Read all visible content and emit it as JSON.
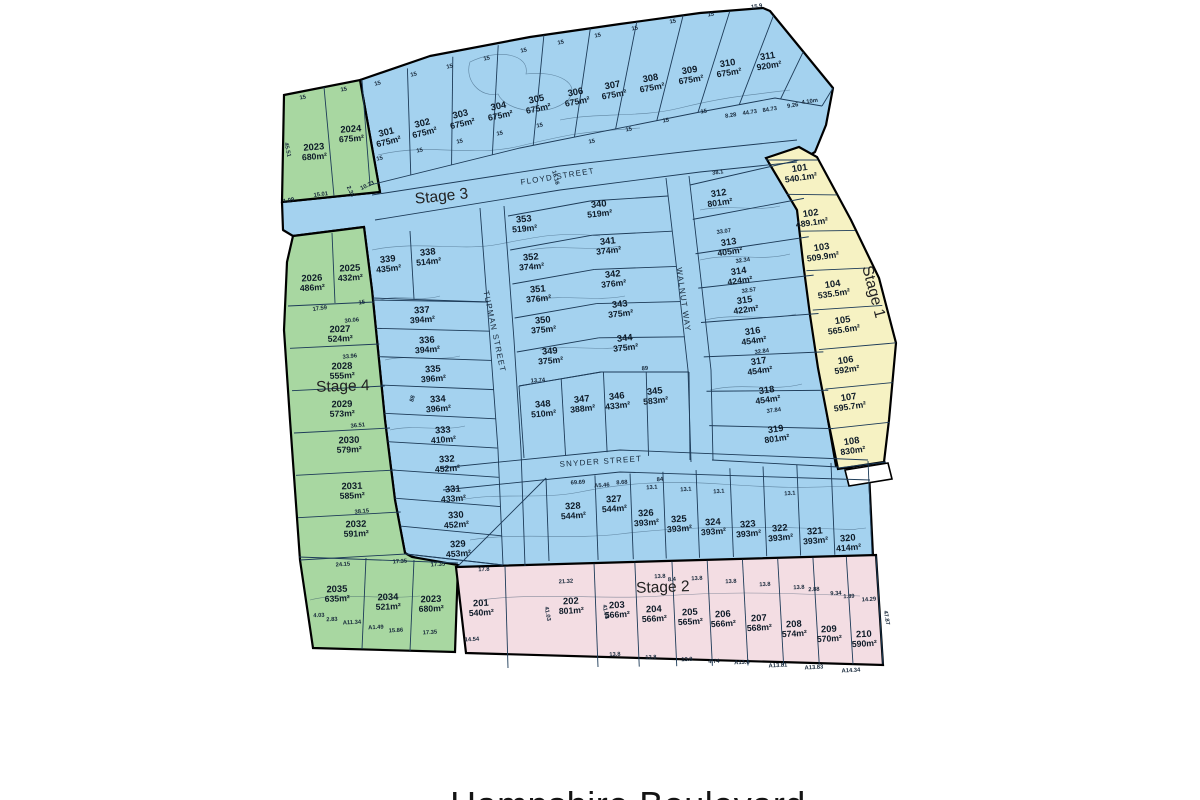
{
  "title": "Hampshire Boulevard",
  "colors": {
    "stage1_fill": "#f6f2c3",
    "stage2_fill": "#f3dde3",
    "stage3_fill": "#a4d2ef",
    "stage4_fill": "#a8d7a1",
    "parcel_line": "#1d3b58",
    "outline": "#000000",
    "background": "#ffffff",
    "label_text": "#0e1b28"
  },
  "streets": [
    {
      "name": "FLOYD STREET",
      "x": 558,
      "y": 179,
      "r": -9
    },
    {
      "name": "TUPMAN STREET",
      "x": 492,
      "y": 332,
      "r": 78
    },
    {
      "name": "WALNUT WAY",
      "x": 681,
      "y": 300,
      "r": 82
    },
    {
      "name": "SNYDER STREET",
      "x": 601,
      "y": 464,
      "r": -4
    }
  ],
  "stages": [
    {
      "label": "Stage 1",
      "x": 869,
      "y": 293,
      "r": 75,
      "lots": [
        {
          "id": "101",
          "area": "540.1m²",
          "x": 800,
          "y": 171,
          "r": -8
        },
        {
          "id": "102",
          "area": "489.1m²",
          "x": 811,
          "y": 216,
          "r": -8
        },
        {
          "id": "103",
          "area": "509.9m²",
          "x": 822,
          "y": 250,
          "r": -8
        },
        {
          "id": "104",
          "area": "535.5m²",
          "x": 833,
          "y": 287,
          "r": -8
        },
        {
          "id": "105",
          "area": "565.6m²",
          "x": 843,
          "y": 323,
          "r": -8
        },
        {
          "id": "106",
          "area": "592m²",
          "x": 846,
          "y": 363,
          "r": -8
        },
        {
          "id": "107",
          "area": "595.7m²",
          "x": 849,
          "y": 400,
          "r": -8
        },
        {
          "id": "108",
          "area": "830m²",
          "x": 852,
          "y": 444,
          "r": -8
        }
      ]
    },
    {
      "label": "Stage 2",
      "x": 663,
      "y": 592,
      "r": -2,
      "lots": [
        {
          "id": "201",
          "area": "540m²",
          "x": 481,
          "y": 606,
          "r": -3
        },
        {
          "id": "202",
          "area": "801m²",
          "x": 571,
          "y": 604,
          "r": -3
        },
        {
          "id": "203",
          "area": "566m²",
          "x": 617,
          "y": 608,
          "r": -3
        },
        {
          "id": "204",
          "area": "566m²",
          "x": 654,
          "y": 612,
          "r": -3
        },
        {
          "id": "205",
          "area": "565m²",
          "x": 690,
          "y": 615,
          "r": -3
        },
        {
          "id": "206",
          "area": "566m²",
          "x": 723,
          "y": 617,
          "r": -3
        },
        {
          "id": "207",
          "area": "568m²",
          "x": 759,
          "y": 621,
          "r": -3
        },
        {
          "id": "208",
          "area": "574m²",
          "x": 794,
          "y": 627,
          "r": -3
        },
        {
          "id": "209",
          "area": "570m²",
          "x": 829,
          "y": 632,
          "r": -3
        },
        {
          "id": "210",
          "area": "590m²",
          "x": 864,
          "y": 637,
          "r": -3
        }
      ]
    },
    {
      "label": "Stage 3",
      "x": 442,
      "y": 201,
      "r": -6,
      "lots": [
        {
          "id": "301",
          "area": "675m²",
          "x": 387,
          "y": 135,
          "r": -14
        },
        {
          "id": "302",
          "area": "675m²",
          "x": 423,
          "y": 126,
          "r": -14
        },
        {
          "id": "303",
          "area": "675m²",
          "x": 461,
          "y": 117,
          "r": -13
        },
        {
          "id": "304",
          "area": "675m²",
          "x": 499,
          "y": 109,
          "r": -12
        },
        {
          "id": "305",
          "area": "675m²",
          "x": 537,
          "y": 102,
          "r": -12
        },
        {
          "id": "306",
          "area": "675m²",
          "x": 576,
          "y": 95,
          "r": -11
        },
        {
          "id": "307",
          "area": "675m²",
          "x": 613,
          "y": 88,
          "r": -10
        },
        {
          "id": "308",
          "area": "675m²",
          "x": 651,
          "y": 81,
          "r": -10
        },
        {
          "id": "309",
          "area": "675m²",
          "x": 690,
          "y": 73,
          "r": -9
        },
        {
          "id": "310",
          "area": "675m²",
          "x": 728,
          "y": 66,
          "r": -9
        },
        {
          "id": "311",
          "area": "920m²",
          "x": 768,
          "y": 59,
          "r": -9
        },
        {
          "id": "312",
          "area": "801m²",
          "x": 719,
          "y": 196,
          "r": -8
        },
        {
          "id": "313",
          "area": "405m²",
          "x": 729,
          "y": 245,
          "r": -8
        },
        {
          "id": "314",
          "area": "424m²",
          "x": 739,
          "y": 274,
          "r": -8
        },
        {
          "id": "315",
          "area": "422m²",
          "x": 745,
          "y": 303,
          "r": -8
        },
        {
          "id": "316",
          "area": "454m²",
          "x": 753,
          "y": 334,
          "r": -8
        },
        {
          "id": "317",
          "area": "454m²",
          "x": 759,
          "y": 364,
          "r": -8
        },
        {
          "id": "318",
          "area": "454m²",
          "x": 767,
          "y": 393,
          "r": -8
        },
        {
          "id": "319",
          "area": "801m²",
          "x": 776,
          "y": 432,
          "r": -8
        },
        {
          "id": "320",
          "area": "414m²",
          "x": 848,
          "y": 541,
          "r": -5
        },
        {
          "id": "321",
          "area": "393m²",
          "x": 815,
          "y": 534,
          "r": -5
        },
        {
          "id": "322",
          "area": "393m²",
          "x": 780,
          "y": 531,
          "r": -5
        },
        {
          "id": "323",
          "area": "393m²",
          "x": 748,
          "y": 527,
          "r": -5
        },
        {
          "id": "324",
          "area": "393m²",
          "x": 713,
          "y": 525,
          "r": -4
        },
        {
          "id": "325",
          "area": "393m²",
          "x": 679,
          "y": 522,
          "r": -4
        },
        {
          "id": "326",
          "area": "393m²",
          "x": 646,
          "y": 516,
          "r": -4
        },
        {
          "id": "327",
          "area": "544m²",
          "x": 614,
          "y": 502,
          "r": -4
        },
        {
          "id": "328",
          "area": "544m²",
          "x": 573,
          "y": 509,
          "r": -4
        },
        {
          "id": "329",
          "area": "453m²",
          "x": 458,
          "y": 547,
          "r": -4
        },
        {
          "id": "330",
          "area": "452m²",
          "x": 456,
          "y": 518,
          "r": -4
        },
        {
          "id": "331",
          "area": "433m²",
          "x": 453,
          "y": 492,
          "r": -4
        },
        {
          "id": "332",
          "area": "452m²",
          "x": 447,
          "y": 462,
          "r": -4
        },
        {
          "id": "333",
          "area": "410m²",
          "x": 443,
          "y": 433,
          "r": -4
        },
        {
          "id": "334",
          "area": "396m²",
          "x": 438,
          "y": 402,
          "r": -4
        },
        {
          "id": "335",
          "area": "396m²",
          "x": 433,
          "y": 372,
          "r": -4
        },
        {
          "id": "336",
          "area": "394m²",
          "x": 427,
          "y": 343,
          "r": -4
        },
        {
          "id": "337",
          "area": "394m²",
          "x": 422,
          "y": 313,
          "r": -4
        },
        {
          "id": "338",
          "area": "514m²",
          "x": 428,
          "y": 255,
          "r": -6
        },
        {
          "id": "339",
          "area": "435m²",
          "x": 388,
          "y": 262,
          "r": -6
        },
        {
          "id": "340",
          "area": "519m²",
          "x": 599,
          "y": 207,
          "r": -6
        },
        {
          "id": "341",
          "area": "374m²",
          "x": 608,
          "y": 244,
          "r": -6
        },
        {
          "id": "342",
          "area": "376m²",
          "x": 613,
          "y": 277,
          "r": -6
        },
        {
          "id": "343",
          "area": "375m²",
          "x": 620,
          "y": 307,
          "r": -6
        },
        {
          "id": "344",
          "area": "375m²",
          "x": 625,
          "y": 341,
          "r": -6
        },
        {
          "id": "345",
          "area": "583m²",
          "x": 655,
          "y": 394,
          "r": -6
        },
        {
          "id": "346",
          "area": "433m²",
          "x": 617,
          "y": 399,
          "r": -6
        },
        {
          "id": "347",
          "area": "388m²",
          "x": 582,
          "y": 402,
          "r": -6
        },
        {
          "id": "348",
          "area": "510m²",
          "x": 543,
          "y": 407,
          "r": -5
        },
        {
          "id": "349",
          "area": "375m²",
          "x": 550,
          "y": 354,
          "r": -5
        },
        {
          "id": "350",
          "area": "375m²",
          "x": 543,
          "y": 323,
          "r": -5
        },
        {
          "id": "351",
          "area": "376m²",
          "x": 538,
          "y": 292,
          "r": -5
        },
        {
          "id": "352",
          "area": "374m²",
          "x": 531,
          "y": 260,
          "r": -5
        },
        {
          "id": "353",
          "area": "519m²",
          "x": 524,
          "y": 222,
          "r": -5
        }
      ]
    },
    {
      "label": "Stage 4",
      "x": 343,
      "y": 391,
      "r": -2,
      "lots": [
        {
          "id": "2023",
          "area": "680m²",
          "x": 314,
          "y": 150,
          "r": -4
        },
        {
          "id": "2024",
          "area": "675m²",
          "x": 351,
          "y": 132,
          "r": -4
        },
        {
          "id": "2026",
          "area": "486m²",
          "x": 312,
          "y": 281,
          "r": -3
        },
        {
          "id": "2025",
          "area": "432m²",
          "x": 350,
          "y": 271,
          "r": -3
        },
        {
          "id": "2027",
          "area": "524m²",
          "x": 340,
          "y": 332,
          "r": -2
        },
        {
          "id": "2028",
          "area": "555m²",
          "x": 342,
          "y": 369,
          "r": -2
        },
        {
          "id": "2029",
          "area": "573m²",
          "x": 342,
          "y": 407,
          "r": -2
        },
        {
          "id": "2030",
          "area": "579m²",
          "x": 349,
          "y": 443,
          "r": -2
        },
        {
          "id": "2031",
          "area": "585m²",
          "x": 352,
          "y": 489,
          "r": -2
        },
        {
          "id": "2032",
          "area": "591m²",
          "x": 356,
          "y": 527,
          "r": -2
        },
        {
          "id": "2035",
          "area": "635m²",
          "x": 337,
          "y": 592,
          "r": -2
        },
        {
          "id": "2034",
          "area": "521m²",
          "x": 388,
          "y": 600,
          "r": -2
        },
        {
          "id": "2023",
          "area": "680m²",
          "x": 431,
          "y": 602,
          "r": -2
        }
      ]
    }
  ],
  "dims": [
    {
      "t": "15",
      "x": 303,
      "y": 99,
      "r": -10
    },
    {
      "t": "15",
      "x": 344,
      "y": 91,
      "r": -10
    },
    {
      "t": "45.51",
      "x": 286,
      "y": 150,
      "r": 78
    },
    {
      "t": "1.09",
      "x": 289,
      "y": 202,
      "r": -12
    },
    {
      "t": "15.01",
      "x": 321,
      "y": 196,
      "r": -8
    },
    {
      "t": "2.35",
      "x": 349,
      "y": 192,
      "r": 65
    },
    {
      "t": "10.23",
      "x": 368,
      "y": 187,
      "r": -25
    },
    {
      "t": "15",
      "x": 378,
      "y": 85,
      "r": -14
    },
    {
      "t": "15",
      "x": 414,
      "y": 76,
      "r": -13
    },
    {
      "t": "15",
      "x": 450,
      "y": 68,
      "r": -13
    },
    {
      "t": "15",
      "x": 487,
      "y": 60,
      "r": -12
    },
    {
      "t": "15",
      "x": 524,
      "y": 52,
      "r": -12
    },
    {
      "t": "15",
      "x": 561,
      "y": 44,
      "r": -11
    },
    {
      "t": "15",
      "x": 598,
      "y": 37,
      "r": -11
    },
    {
      "t": "15",
      "x": 635,
      "y": 30,
      "r": -10
    },
    {
      "t": "15",
      "x": 673,
      "y": 23,
      "r": -10
    },
    {
      "t": "15",
      "x": 711,
      "y": 16,
      "r": -9
    },
    {
      "t": "15.9",
      "x": 757,
      "y": 8,
      "r": -9
    },
    {
      "t": "15",
      "x": 380,
      "y": 160,
      "r": -13
    },
    {
      "t": "15",
      "x": 420,
      "y": 152,
      "r": -12
    },
    {
      "t": "15",
      "x": 460,
      "y": 143,
      "r": -12
    },
    {
      "t": "15",
      "x": 500,
      "y": 135,
      "r": -11
    },
    {
      "t": "15",
      "x": 540,
      "y": 127,
      "r": -11
    },
    {
      "t": "15",
      "x": 592,
      "y": 143,
      "r": -10
    },
    {
      "t": "15",
      "x": 629,
      "y": 131,
      "r": -10
    },
    {
      "t": "15",
      "x": 666,
      "y": 122,
      "r": -9
    },
    {
      "t": "15",
      "x": 704,
      "y": 113,
      "r": -9
    },
    {
      "t": "8.28",
      "x": 731,
      "y": 117,
      "r": -9
    },
    {
      "t": "44.73",
      "x": 750,
      "y": 114,
      "r": -9
    },
    {
      "t": "84.73",
      "x": 770,
      "y": 111,
      "r": -9
    },
    {
      "t": "9.26",
      "x": 793,
      "y": 107,
      "r": -9
    },
    {
      "t": "4.10m",
      "x": 810,
      "y": 103,
      "r": -9
    },
    {
      "t": "38.1",
      "x": 718,
      "y": 174,
      "r": -8
    },
    {
      "t": "16.16",
      "x": 554,
      "y": 178,
      "r": 75
    },
    {
      "t": "17.59",
      "x": 320,
      "y": 310,
      "r": -8
    },
    {
      "t": "15",
      "x": 362,
      "y": 304,
      "r": -8
    },
    {
      "t": "30.06",
      "x": 352,
      "y": 322,
      "r": -6
    },
    {
      "t": "33.96",
      "x": 350,
      "y": 358,
      "r": -6
    },
    {
      "t": "36.51",
      "x": 358,
      "y": 427,
      "r": -6
    },
    {
      "t": "38.15",
      "x": 362,
      "y": 513,
      "r": -6
    },
    {
      "t": "24.15",
      "x": 343,
      "y": 566,
      "r": -4
    },
    {
      "t": "17.35",
      "x": 400,
      "y": 563,
      "r": -4
    },
    {
      "t": "17.35",
      "x": 438,
      "y": 566,
      "r": -4
    },
    {
      "t": "17.8",
      "x": 484,
      "y": 571,
      "r": -3
    },
    {
      "t": "17.35",
      "x": 430,
      "y": 634,
      "r": -3
    },
    {
      "t": "14.54",
      "x": 472,
      "y": 641,
      "r": -3
    },
    {
      "t": "4.03",
      "x": 319,
      "y": 617,
      "r": -3
    },
    {
      "t": "2.83",
      "x": 332,
      "y": 621,
      "r": -3
    },
    {
      "t": "A11.34",
      "x": 352,
      "y": 624,
      "r": -3
    },
    {
      "t": "A1.49",
      "x": 376,
      "y": 629,
      "r": -3
    },
    {
      "t": "15.86",
      "x": 396,
      "y": 632,
      "r": -3
    },
    {
      "t": "21.32",
      "x": 566,
      "y": 583,
      "r": -3
    },
    {
      "t": "13.8",
      "x": 660,
      "y": 578,
      "r": -3
    },
    {
      "t": "8.4",
      "x": 672,
      "y": 581,
      "r": -3
    },
    {
      "t": "13.8",
      "x": 697,
      "y": 580,
      "r": -3
    },
    {
      "t": "13.8",
      "x": 731,
      "y": 583,
      "r": -3
    },
    {
      "t": "13.8",
      "x": 765,
      "y": 586,
      "r": -3
    },
    {
      "t": "13.8",
      "x": 799,
      "y": 589,
      "r": -3
    },
    {
      "t": "2.88",
      "x": 814,
      "y": 591,
      "r": -3
    },
    {
      "t": "9.34",
      "x": 836,
      "y": 595,
      "r": -3
    },
    {
      "t": "1.89",
      "x": 849,
      "y": 598,
      "r": -3
    },
    {
      "t": "14.29",
      "x": 869,
      "y": 601,
      "r": -3
    },
    {
      "t": "13.8",
      "x": 615,
      "y": 656,
      "r": -3
    },
    {
      "t": "13.8",
      "x": 651,
      "y": 659,
      "r": -3
    },
    {
      "t": "13.8",
      "x": 687,
      "y": 661,
      "r": -3
    },
    {
      "t": "4.74",
      "x": 714,
      "y": 663,
      "r": -3
    },
    {
      "t": "A13.8",
      "x": 742,
      "y": 664,
      "r": -3
    },
    {
      "t": "A13.81",
      "x": 778,
      "y": 667,
      "r": -3
    },
    {
      "t": "A13.83",
      "x": 814,
      "y": 669,
      "r": -3
    },
    {
      "t": "A14.34",
      "x": 851,
      "y": 672,
      "r": -3
    },
    {
      "t": "47.87",
      "x": 885,
      "y": 618,
      "r": 80
    },
    {
      "t": "41.03",
      "x": 546,
      "y": 614,
      "r": 80
    },
    {
      "t": "41.05",
      "x": 604,
      "y": 612,
      "r": 80
    },
    {
      "t": "69.69",
      "x": 578,
      "y": 484,
      "r": -4
    },
    {
      "t": "A5.46",
      "x": 602,
      "y": 487,
      "r": -4
    },
    {
      "t": "8.68",
      "x": 622,
      "y": 484,
      "r": -4
    },
    {
      "t": "13.1",
      "x": 652,
      "y": 489,
      "r": -4
    },
    {
      "t": "13.1",
      "x": 686,
      "y": 491,
      "r": -4
    },
    {
      "t": "13.1",
      "x": 719,
      "y": 493,
      "r": -4
    },
    {
      "t": "13.1",
      "x": 790,
      "y": 495,
      "r": -4
    },
    {
      "t": "33.07",
      "x": 724,
      "y": 233,
      "r": -8
    },
    {
      "t": "32.34",
      "x": 743,
      "y": 262,
      "r": -8
    },
    {
      "t": "32.57",
      "x": 749,
      "y": 292,
      "r": -8
    },
    {
      "t": "32.84",
      "x": 762,
      "y": 353,
      "r": -8
    },
    {
      "t": "37.84",
      "x": 774,
      "y": 412,
      "r": -8
    },
    {
      "t": "13.74",
      "x": 538,
      "y": 382,
      "r": -4
    },
    {
      "t": "89",
      "x": 645,
      "y": 370,
      "r": -4
    },
    {
      "t": "88",
      "x": 414,
      "y": 399,
      "r": -75
    },
    {
      "t": "84",
      "x": 660,
      "y": 481,
      "r": -4
    }
  ]
}
